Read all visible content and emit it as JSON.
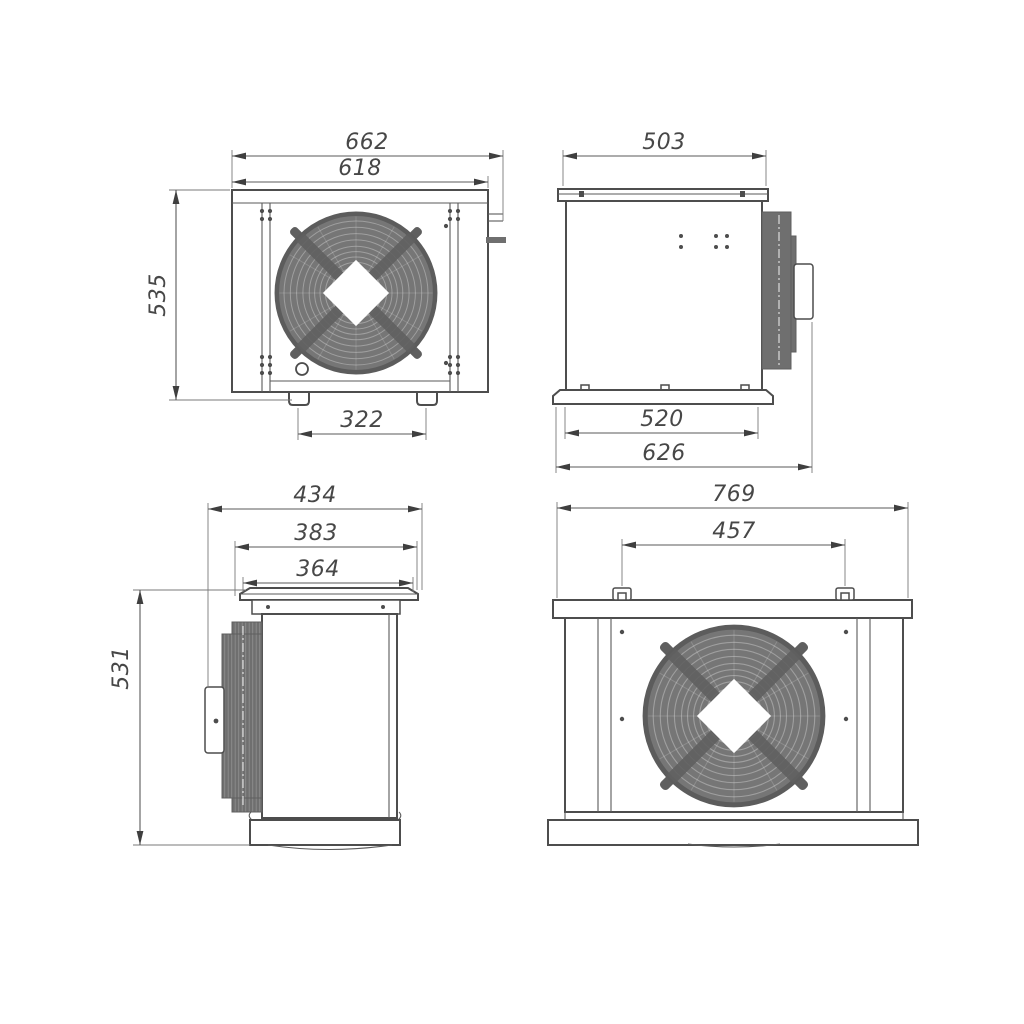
{
  "drawing": {
    "views": {
      "front": {
        "overall_width": "662",
        "body_width": "618",
        "height": "535",
        "feet_spacing": "322"
      },
      "side_right": {
        "top_width": "503",
        "base_width": "520",
        "overall_depth": "626"
      },
      "side_left": {
        "overall_width": "434",
        "flange_width": "383",
        "duct_width": "364",
        "height": "531"
      },
      "back": {
        "overall_width": "769",
        "bracket_spacing": "457"
      }
    },
    "colors": {
      "line": "#4d4d4d",
      "fan_fill": "#767676",
      "coil_fill": "#6f6f6f",
      "background": "#ffffff"
    }
  }
}
